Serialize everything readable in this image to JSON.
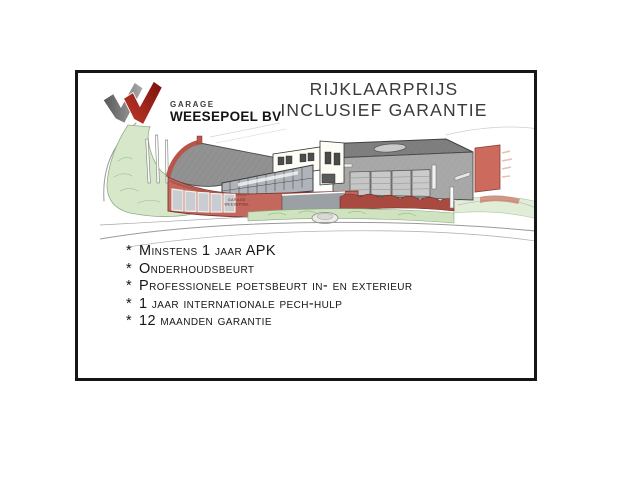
{
  "frame": {
    "border_color": "#161616"
  },
  "logo": {
    "garage_label": "GARAGE",
    "company_name": "WEESEPOEL BV",
    "mark_colors": {
      "gray_dark": "#585858",
      "gray_light": "#a9a9a9",
      "red_bright": "#c23b2c",
      "red_dark": "#7a100a"
    }
  },
  "title": {
    "line1": "RIJKLAARPRIJS",
    "line2": "INCLUSIEF GARANTIE"
  },
  "illustration": {
    "alt": "Hand-drawn colored-pencil sketch of the Garage Weesepoel dealership: curved red-brick showroom with gray roof, white office block, glass facade, gray workshop with garage doors, flagpoles and green landscaping",
    "building_sign": {
      "line1": "GARAGE",
      "line2": "WEESEPOEL"
    },
    "colors": {
      "brick_red": "#c4685e",
      "roof_gray": "#929292",
      "workshop_gray": "#a8a8a8",
      "door_gray": "#c6c6c6",
      "glass_gray": "#b0b4ba",
      "grass_green": "#d7e7ca",
      "shrub_red": "#a84a40",
      "sketch_line": "#9a9a9a"
    }
  },
  "features": {
    "marker": "*",
    "items": [
      "Minstens 1 jaar APK",
      "Onderhoudsbeurt",
      "Professionele poetsbeurt in- en exterieur",
      "1 jaar internationale pech-hulp",
      "12 maanden garantie"
    ]
  }
}
